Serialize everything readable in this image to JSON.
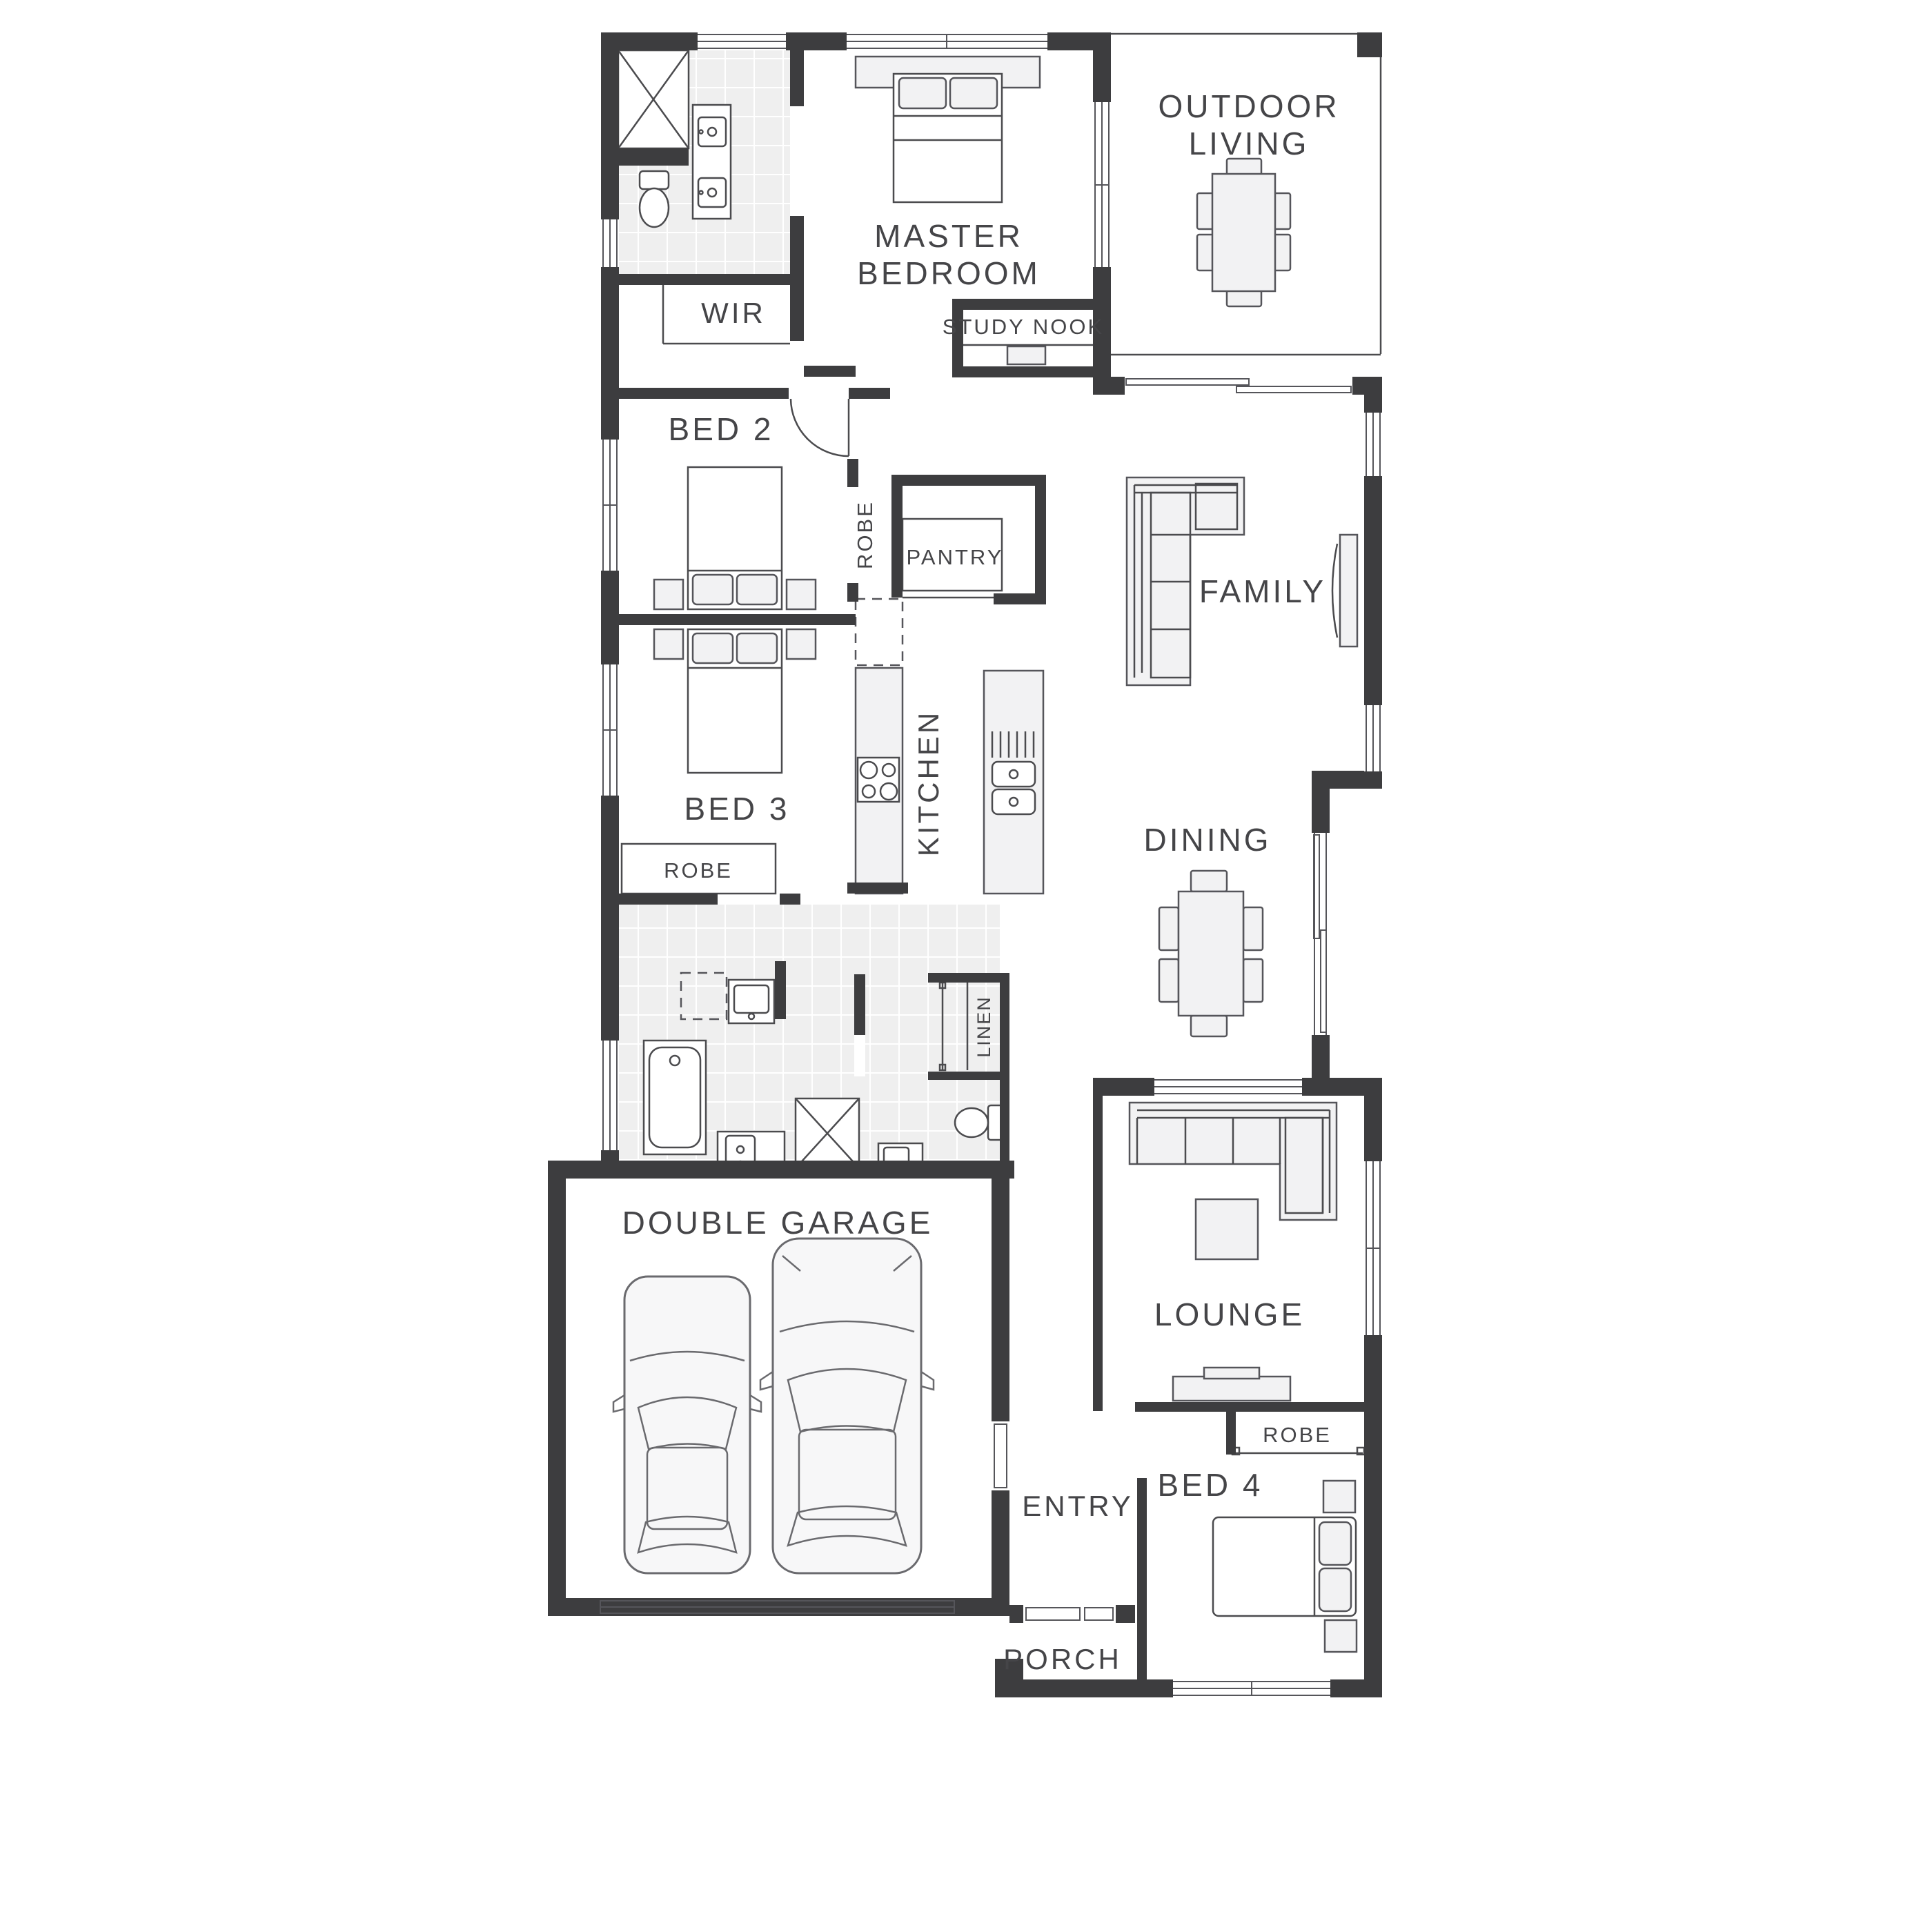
{
  "plan": {
    "colors": {
      "wall": "#3d3d3f",
      "label_text": "#454548",
      "furniture_fill": "#f2f2f3",
      "furniture_stroke": "#55555a",
      "tile_fill": "#efefef",
      "background": "#ffffff"
    },
    "rooms": {
      "outdoor_living": {
        "line1": "OUTDOOR",
        "line2": "LIVING"
      },
      "master_bedroom": {
        "line1": "MASTER",
        "line2": "BEDROOM"
      },
      "wir": {
        "label": "WIR"
      },
      "study_nook": {
        "label": "STUDY NOOK"
      },
      "bed2": {
        "label": "BED 2"
      },
      "robe_bed2": {
        "label": "ROBE"
      },
      "pantry": {
        "label": "PANTRY"
      },
      "family": {
        "label": "FAMILY"
      },
      "kitchen": {
        "label": "KITCHEN"
      },
      "bed3": {
        "label": "BED 3"
      },
      "robe_bed3": {
        "label": "ROBE"
      },
      "dining": {
        "label": "DINING"
      },
      "linen": {
        "label": "LINEN"
      },
      "double_garage": {
        "label": "DOUBLE GARAGE"
      },
      "lounge": {
        "label": "LOUNGE"
      },
      "robe_bed4": {
        "label": "ROBE"
      },
      "entry": {
        "label": "ENTRY"
      },
      "bed4": {
        "label": "BED 4"
      },
      "porch": {
        "label": "PORCH"
      }
    }
  }
}
